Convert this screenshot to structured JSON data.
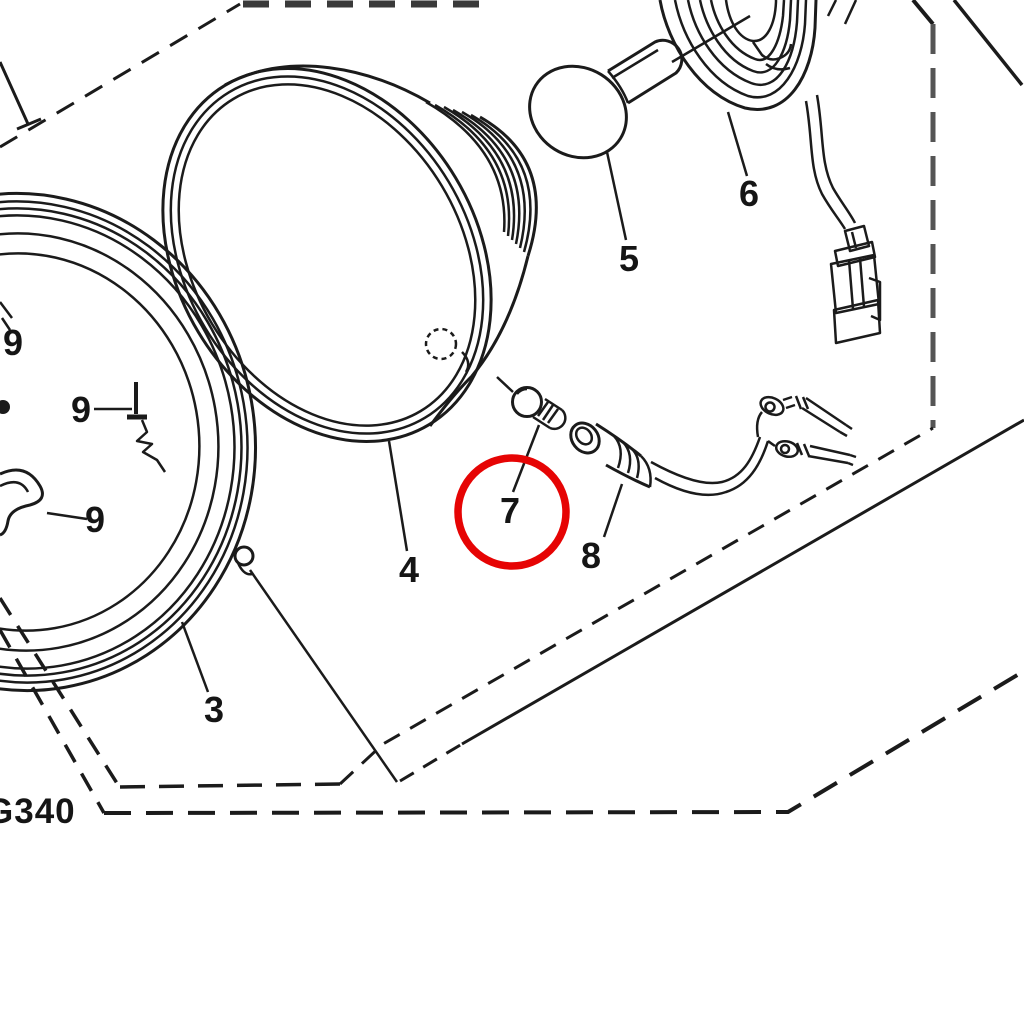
{
  "diagram": {
    "type": "exploded-parts-diagram",
    "subject": "headlight-assembly",
    "drawing_code": "G340",
    "background": "#ffffff",
    "line_color": "#1b1b1b",
    "highlight_color": "#e60404",
    "highlighted_part": "7",
    "labels": [
      {
        "part": "3",
        "x": 214,
        "y": 710,
        "highlighted": false
      },
      {
        "part": "4",
        "x": 409,
        "y": 570,
        "highlighted": false
      },
      {
        "part": "5",
        "x": 629,
        "y": 259,
        "highlighted": false
      },
      {
        "part": "6",
        "x": 749,
        "y": 194,
        "highlighted": false
      },
      {
        "part": "7",
        "x": 510,
        "y": 511,
        "highlighted": true
      },
      {
        "part": "8",
        "x": 591,
        "y": 556,
        "highlighted": false
      },
      {
        "part": "9",
        "x": 13,
        "y": 343,
        "highlighted": false
      },
      {
        "part": "9",
        "x": 81,
        "y": 410,
        "highlighted": false
      },
      {
        "part": "9",
        "x": 95,
        "y": 520,
        "highlighted": false
      }
    ]
  }
}
